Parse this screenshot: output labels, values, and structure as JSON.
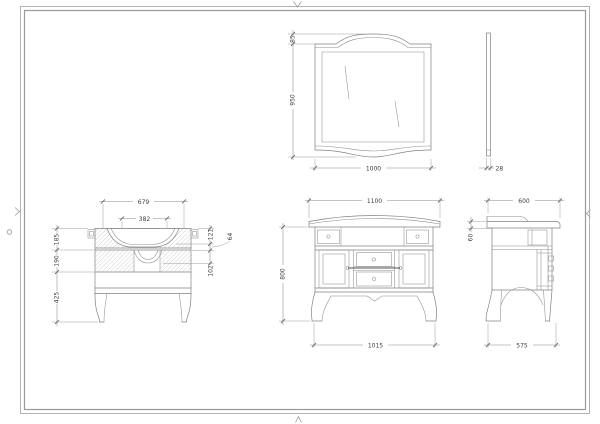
{
  "style": {
    "paper_color": "#ffffff",
    "line_color": "#828282",
    "dim_text_color": "#3d3d3d",
    "border_color": "#9a9a9a"
  },
  "views": {
    "mirror_front": {
      "dims": {
        "arch_rise": "85",
        "height": "950",
        "width": "1000"
      }
    },
    "mirror_side": {
      "dims": {
        "thickness": "28"
      }
    },
    "vanity_section": {
      "dims": {
        "basin_outer_width": "679",
        "basin_inner_width": "382",
        "counter_zone_height": "185",
        "mid_zone_height": "190",
        "lower_zone_height": "425",
        "rim_depth": "121",
        "step_depth": "64",
        "bowl_depth": "102"
      }
    },
    "vanity_front": {
      "dims": {
        "width": "1100",
        "height": "800",
        "base_width": "1015"
      }
    },
    "vanity_side": {
      "dims": {
        "depth": "600",
        "counter_thickness": "60",
        "base_depth": "575"
      }
    }
  }
}
